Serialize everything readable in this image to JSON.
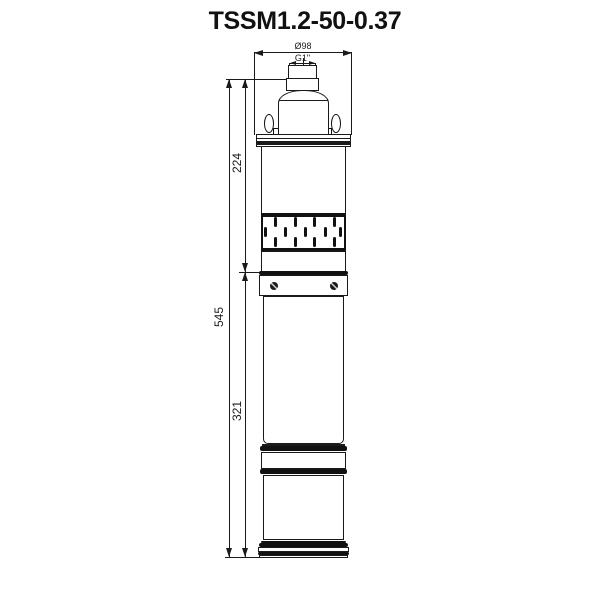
{
  "title": "TSSM1.2-50-0.37",
  "drawing": {
    "type": "submersible-pump-outline-drawing",
    "line_color": "#1a1a1a",
    "dimensions": {
      "diameter": "Ø98",
      "outlet_thread": "G1\"",
      "upper_section_length": "224",
      "total_length": "545",
      "lower_section_length": "321"
    }
  }
}
